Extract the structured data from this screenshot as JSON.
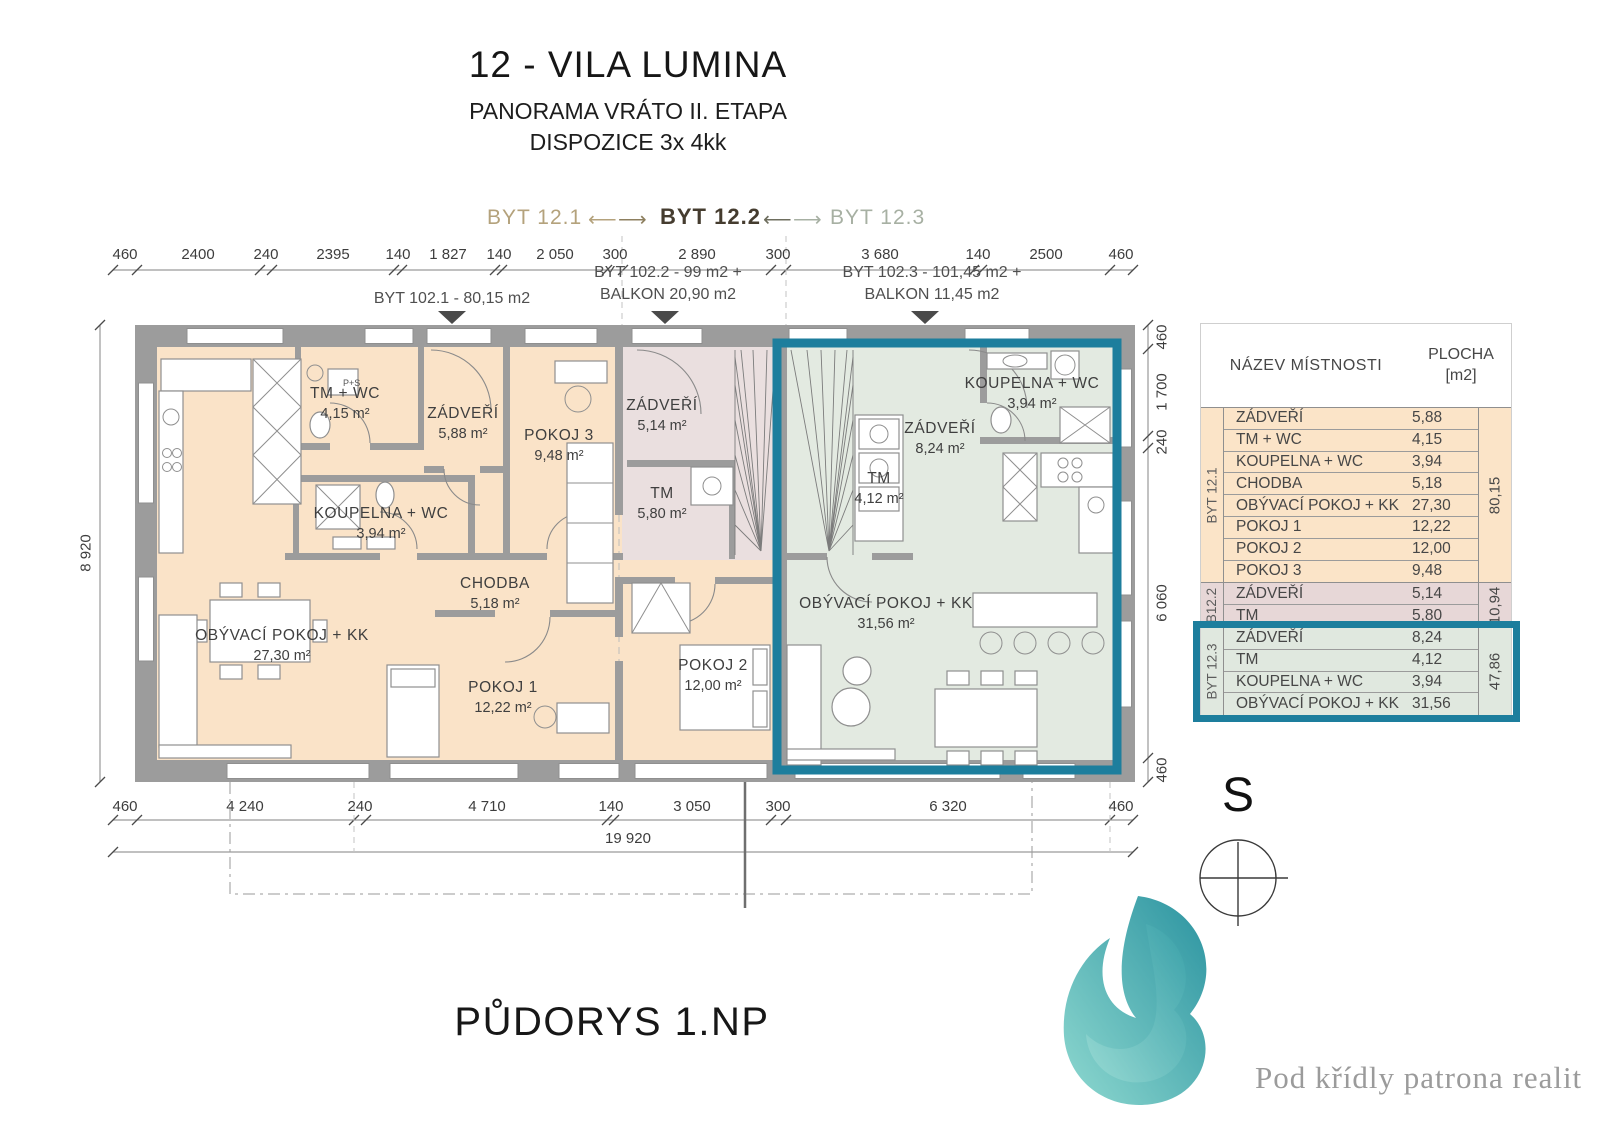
{
  "header": {
    "title": "12 - VILA LUMINA",
    "subtitle1": "PANORAMA VRÁTO II. ETAPA",
    "subtitle2": "DISPOZICE 3x 4kk"
  },
  "units_nav": {
    "unit1": "BYT 12.1",
    "unit2": "BYT 12.2",
    "unit3": "BYT 12.3",
    "arrow_left": "⟵",
    "arrow_right": "⟶"
  },
  "callouts": {
    "unit1": "BYT 102.1 - 80,15 m2",
    "unit2_line1": "BYT 102.2 - 99 m2 +",
    "unit2_line2": "BALKON 20,90 m2",
    "unit3_line1": "BYT 102.3 - 101,45 m2 +",
    "unit3_line2": "BALKON 11,45 m2"
  },
  "dims": {
    "top": [
      "460",
      "2400",
      "240",
      "2395",
      "140",
      "1 827",
      "140",
      "2 050",
      "300",
      "2 890",
      "300",
      "3 680",
      "140",
      "2500",
      "460"
    ],
    "bottom": [
      "460",
      "4 240",
      "240",
      "4 710",
      "140",
      "3 050",
      "300",
      "6 320",
      "460"
    ],
    "bottom_total": "19 920",
    "left_total": "8 920",
    "right": [
      "460",
      "1 700",
      "240",
      "6 060",
      "460"
    ]
  },
  "rooms": {
    "tm_wc": {
      "name": "TM + WC",
      "area": "4,15 m²"
    },
    "zadveri1": {
      "name": "ZÁDVEŘÍ",
      "area": "5,88 m²"
    },
    "pokoj3": {
      "name": "POKOJ 3",
      "area": "9,48 m²"
    },
    "koupelna1": {
      "name": "KOUPELNA + WC",
      "area": "3,94 m²"
    },
    "chodba": {
      "name": "CHODBA",
      "area": "5,18 m²"
    },
    "obyvaci1": {
      "name": "OBÝVACÍ POKOJ + KK",
      "area": "27,30 m²"
    },
    "pokoj1": {
      "name": "POKOJ 1",
      "area": "12,22 m²"
    },
    "pokoj2": {
      "name": "POKOJ 2",
      "area": "12,00 m²"
    },
    "zadveri2": {
      "name": "ZÁDVEŘÍ",
      "area": "5,14 m²"
    },
    "tm2": {
      "name": "TM",
      "area": "5,80 m²"
    },
    "zadveri3": {
      "name": "ZÁDVEŘÍ",
      "area": "8,24 m²"
    },
    "tm3": {
      "name": "TM",
      "area": "4,12 m²"
    },
    "koupelna3": {
      "name": "KOUPELNA + WC",
      "area": "3,94 m²"
    },
    "obyvaci3": {
      "name": "OBÝVACÍ POKOJ + KK",
      "area": "31,56 m²"
    },
    "ps_label": "P+S"
  },
  "room_table": {
    "header_name": "NÁZEV MÍSTNOSTI",
    "header_area_line1": "PLOCHA",
    "header_area_line2": "[m2]",
    "groups": [
      {
        "label": "BYT 12.1",
        "total": "80,15",
        "rows": [
          [
            "ZÁDVEŘÍ",
            "5,88"
          ],
          [
            "TM + WC",
            "4,15"
          ],
          [
            "KOUPELNA + WC",
            "3,94"
          ],
          [
            "CHODBA",
            "5,18"
          ],
          [
            "OBÝVACÍ POKOJ + KK",
            "27,30"
          ],
          [
            "POKOJ 1",
            "12,22"
          ],
          [
            "POKOJ 2",
            "12,00"
          ],
          [
            "POKOJ 3",
            "9,48"
          ]
        ]
      },
      {
        "label": "B12.2",
        "total": "10,94",
        "rows": [
          [
            "ZÁDVEŘÍ",
            "5,14"
          ],
          [
            "TM",
            "5,80"
          ]
        ]
      },
      {
        "label": "BYT 12.3",
        "total": "47,86",
        "rows": [
          [
            "ZÁDVEŘÍ",
            "8,24"
          ],
          [
            "TM",
            "4,12"
          ],
          [
            "KOUPELNA + WC",
            "3,94"
          ],
          [
            "OBÝVACÍ POKOJ + KK",
            "31,56"
          ]
        ]
      }
    ]
  },
  "footer": {
    "plan_label": "PŮDORYS 1.NP",
    "compass_label": "S",
    "tagline": "Pod křídly patrona realit"
  },
  "colors": {
    "accent_teal": "#1d7e9d",
    "unit1_fill": "#fae3c8",
    "unit2_fill": "#eadfdf",
    "unit3_fill": "#e3eae1",
    "wall_gray": "#9c9c9c"
  }
}
